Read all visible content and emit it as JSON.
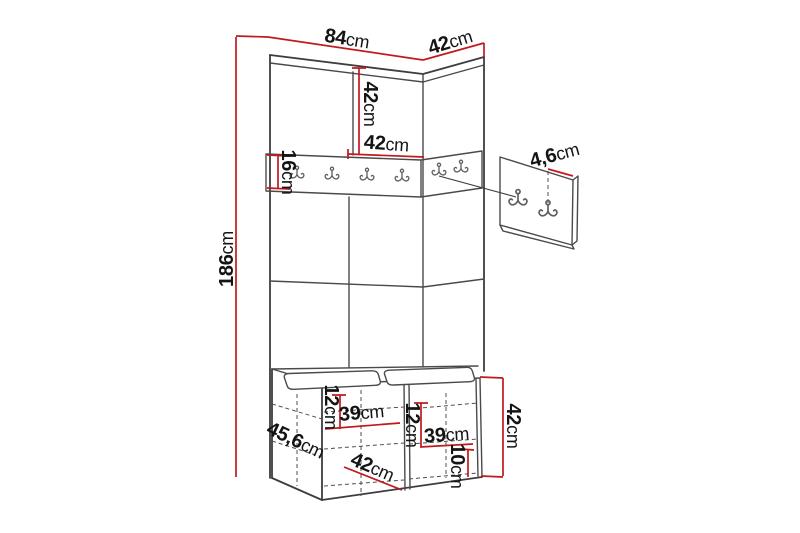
{
  "colors": {
    "background": "#ffffff",
    "structure_line": "#4a4a4a",
    "dimension_line": "#c2191d",
    "label_text": "#141414",
    "hook_line": "#5f5f5f"
  },
  "diagram": {
    "subject": "hallway wardrobe set dimension drawing",
    "parts": [
      "tall panel unit with doors",
      "coat hook rail",
      "separate wall hook panel",
      "storage bench with two seat cushions"
    ],
    "rail_hook_count": 6,
    "panel_hook_count": 2
  },
  "dimensions": {
    "top_width": {
      "value": "84",
      "unit": "cm"
    },
    "top_depth": {
      "value": "42",
      "unit": "cm"
    },
    "total_height": {
      "value": "186",
      "unit": "cm"
    },
    "upper_door_height": {
      "value": "42",
      "unit": "cm"
    },
    "upper_door_width": {
      "value": "42",
      "unit": "cm"
    },
    "rail_height": {
      "value": "16",
      "unit": "cm"
    },
    "hook_panel_offset": {
      "value": "4,6",
      "unit": "cm"
    },
    "bench_left_drawer_height": {
      "value": "12",
      "unit": "cm"
    },
    "bench_left_width": {
      "value": "39",
      "unit": "cm"
    },
    "bench_side_depth": {
      "value": "45,6",
      "unit": "cm"
    },
    "bench_door_width": {
      "value": "42",
      "unit": "cm"
    },
    "bench_right_drawer_height": {
      "value": "12",
      "unit": "cm"
    },
    "bench_right_width": {
      "value": "39",
      "unit": "cm"
    },
    "bench_right_bottom_height": {
      "value": "10",
      "unit": "cm"
    },
    "bench_height": {
      "value": "42",
      "unit": "cm"
    }
  }
}
